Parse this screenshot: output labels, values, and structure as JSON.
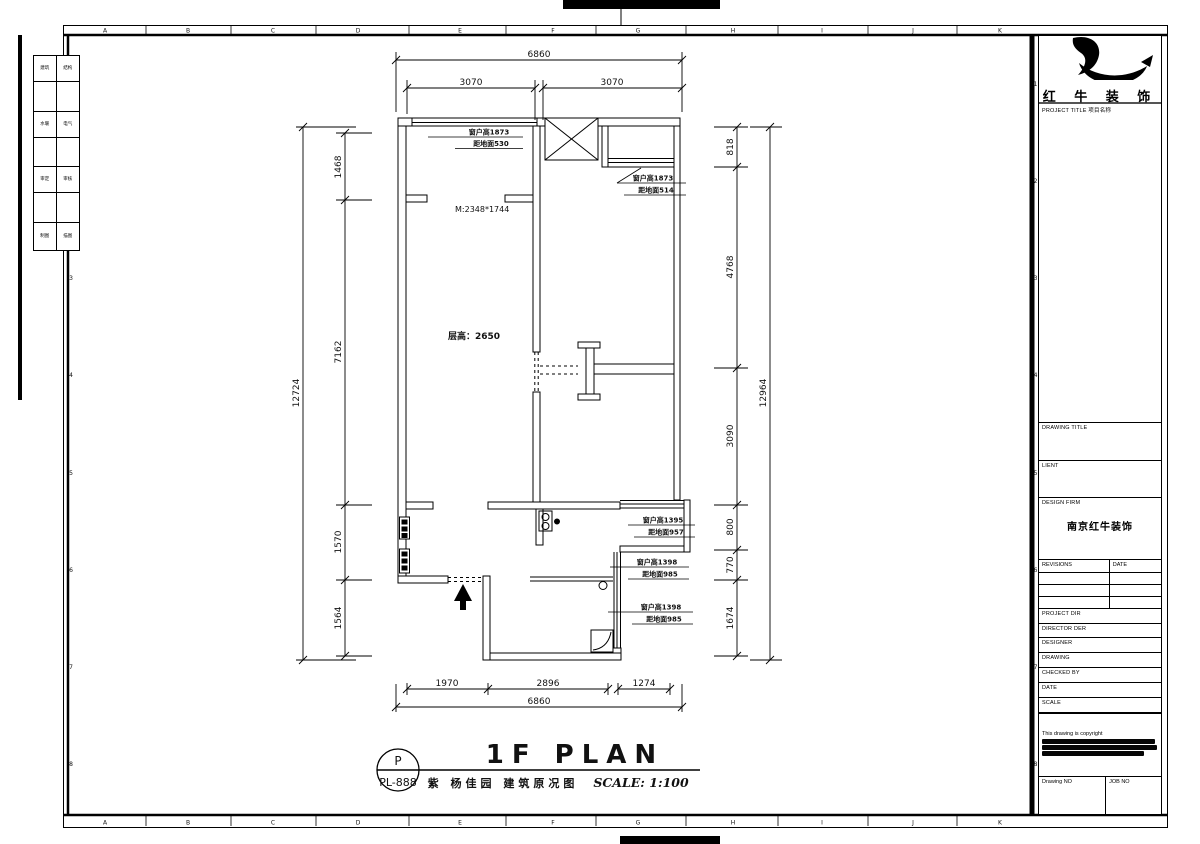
{
  "sheet": {
    "letters": [
      "A",
      "B",
      "C",
      "D",
      "E",
      "F",
      "G",
      "H",
      "I",
      "J",
      "K"
    ],
    "numbers": [
      "1",
      "2",
      "3",
      "4",
      "5",
      "6",
      "7",
      "8"
    ]
  },
  "margin_table": {
    "rows": [
      [
        "建筑",
        "结构"
      ],
      [
        "水暖",
        "电气"
      ],
      [
        "审定",
        "审核"
      ],
      [
        "制图",
        "描图"
      ]
    ]
  },
  "title_block": {
    "brand": "红 牛 装 饰",
    "project_title_label": "PROJECT TITLE 项目名称",
    "drawing_title_label": "DRAWING TITLE",
    "client_label": "LIENT",
    "design_firm_label": "DESIGN FIRM",
    "design_firm_value": "南京红牛装饰",
    "revisions_label": "REVISIONS",
    "date_col_label": "DATE",
    "row_labels": [
      "PROJECT DIR",
      "DIRECTOR DER",
      "DESIGNER",
      "DRAWING",
      "CHECKED BY",
      "DATE",
      "SCALE"
    ],
    "copyright_line": "This drawing is copyright",
    "drawing_no_label": "Drawing NO",
    "job_no_label": "JOB NO"
  },
  "plan": {
    "floor_height": "层高：2650",
    "opening": "M:2348*1744",
    "windows": {
      "w1a": "窗户高1873",
      "w1b": "距地面530",
      "w2a": "窗户高1873",
      "w2b": "距地面514",
      "w3a": "窗户高1395",
      "w3b": "距地面957",
      "w4a": "窗户高1398",
      "w4b": "距地面985",
      "w5a": "窗户高1398",
      "w5b": "距地面985"
    },
    "dims": {
      "top_overall": "6860",
      "top_1": "3070",
      "top_2": "3070",
      "bottom_1": "1970",
      "bottom_2": "2896",
      "bottom_3": "1274",
      "bottom_overall": "6860",
      "left_1": "1468",
      "left_2": "7162",
      "left_3": "1570",
      "left_4": "1564",
      "left_overall": "12724",
      "right_1": "818",
      "right_2": "4768",
      "right_3": "3090",
      "right_4": "800",
      "right_5": "770",
      "right_6": "1674",
      "right_overall": "12964"
    }
  },
  "footer": {
    "sheet_letter": "P",
    "sheet_number": "PL-888",
    "title": "1F PLAN",
    "subtitle": "紫 杨佳园 建筑原况图",
    "scale": "SCALE: 1:100"
  }
}
